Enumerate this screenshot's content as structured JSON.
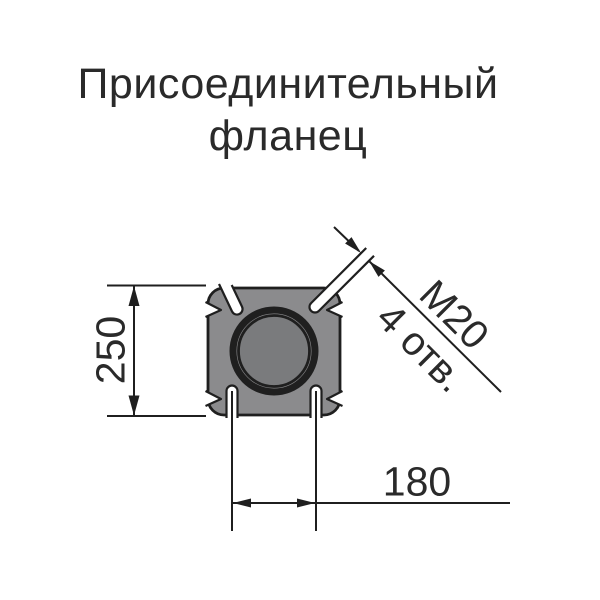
{
  "title": {
    "line1": "Присоединительный",
    "line2": "фланец"
  },
  "labels": {
    "height": "250",
    "spacing": "180",
    "thread": "М20",
    "holes_count": "4 отв."
  },
  "colors": {
    "background": "#ffffff",
    "flange_body": "#8b8b8d",
    "bore_fill": "#7a7b7d",
    "line": "#1f1f1f",
    "text": "#2a2a2a"
  }
}
